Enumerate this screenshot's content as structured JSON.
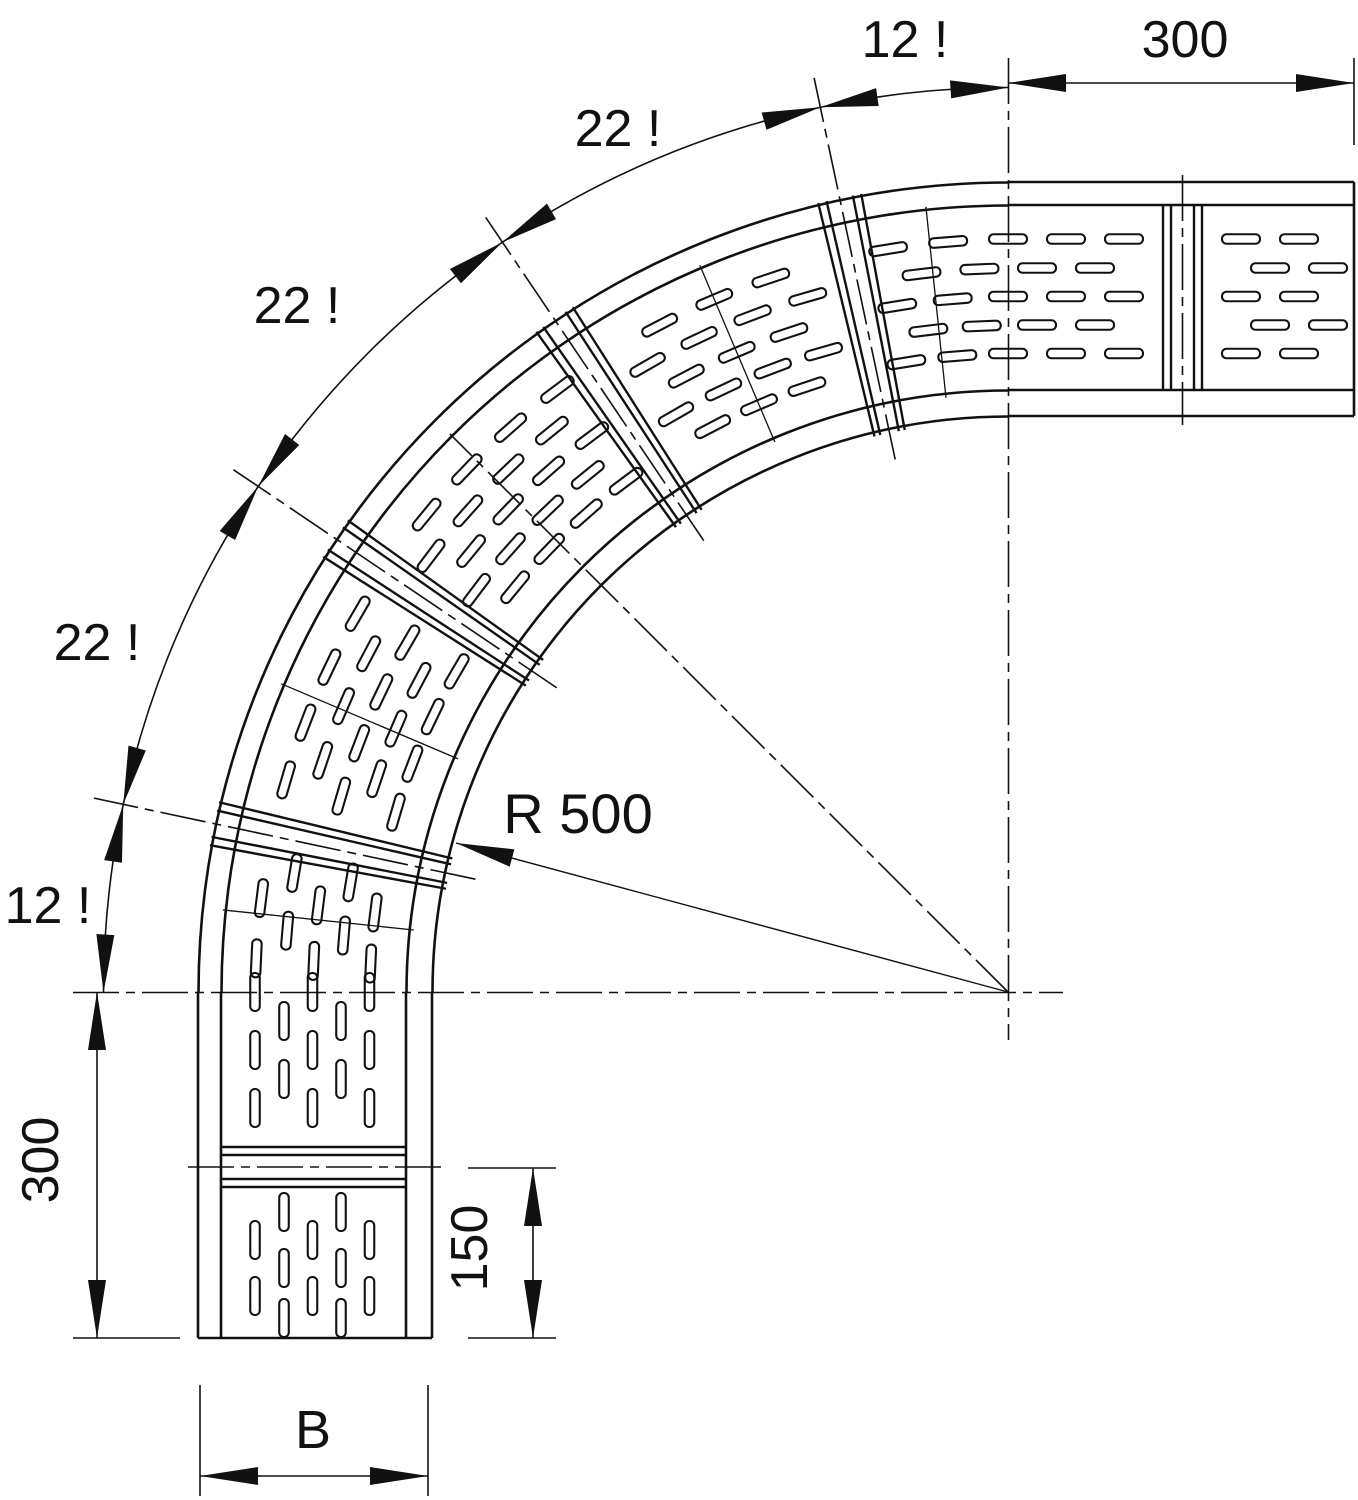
{
  "title": "90 degree cable tray bend - dimensioned technical drawing",
  "colors": {
    "line": "#111111",
    "background": "#ffffff"
  },
  "dimensions": {
    "segment_angles": [
      {
        "label": "12 !",
        "value": 12
      },
      {
        "label": "22 !",
        "value": 22
      },
      {
        "label": "22 !",
        "value": 22
      },
      {
        "label": "22 !",
        "value": 22
      },
      {
        "label": "12 !",
        "value": 12
      }
    ],
    "tangent_top": {
      "label": "300",
      "value": 300
    },
    "tangent_left": {
      "label": "300",
      "value": 300
    },
    "end_segment": {
      "label": "150",
      "value": 150
    },
    "tray_width": {
      "label": "B"
    },
    "bend_radius": {
      "label": "R 500",
      "value": 500
    }
  }
}
